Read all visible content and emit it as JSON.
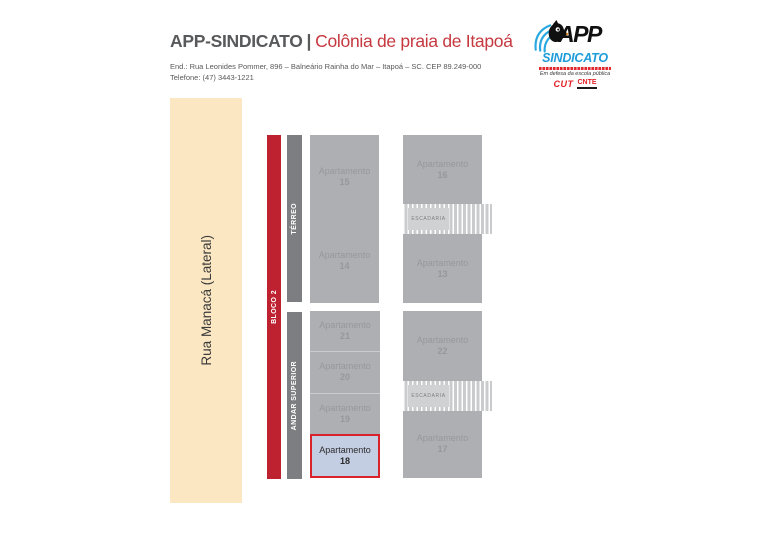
{
  "header": {
    "title_main": "APP-SINDICATO",
    "title_separator": "|",
    "title_sub": "Colônia de praia de Itapoá",
    "address_line1": "End.: Rua Leonides Pommer, 896 – Balneário Rainha do Mar – Itapoá – SC. CEP 89.249-000",
    "address_line2": "Telefone: (47) 3443-1221"
  },
  "logo": {
    "app_text": "APP",
    "sindicato_text": "SINDICATO",
    "tagline": "Em defesa da escola pública",
    "cut_label": "CUT",
    "cnte_label": "CNTE"
  },
  "street": {
    "label": "Rua Manacá (Lateral)"
  },
  "bloco": {
    "label": "BLOCO 2"
  },
  "floors": {
    "terreo": {
      "label": "TÉRREO",
      "left_units": [
        {
          "name": "Apartamento",
          "number": "15"
        },
        {
          "name": "Apartamento",
          "number": "14"
        }
      ],
      "right_units": [
        {
          "name": "Apartamento",
          "number": "16"
        },
        {
          "name": "Apartamento",
          "number": "13"
        }
      ],
      "stairs_label": "ESCADARIA"
    },
    "andar_superior": {
      "label": "ANDAR SUPERIOR",
      "left_units": [
        {
          "name": "Apartamento",
          "number": "21"
        },
        {
          "name": "Apartamento",
          "number": "20"
        },
        {
          "name": "Apartamento",
          "number": "19"
        },
        {
          "name": "Apartamento",
          "number": "18",
          "highlighted": true
        }
      ],
      "right_units": [
        {
          "name": "Apartamento",
          "number": "22"
        },
        {
          "name": "Apartamento",
          "number": "17"
        }
      ],
      "stairs_label": "ESCADARIA"
    }
  },
  "colors": {
    "title_dark": "#58595B",
    "title_red": "#C5393F",
    "logo_blue": "#1E9CD9",
    "logo_red": "#E31E24",
    "street_bg": "#FBE8C3",
    "bloco_red": "#BE2130",
    "floor_strip_gray": "#7C7E81",
    "block_gray": "#ADAFB2",
    "unit_text_gray": "#96989B",
    "stairs_bg": "#C9CBCD",
    "highlight_bg": "#C4CEE3",
    "highlight_border": "#D8232A"
  }
}
